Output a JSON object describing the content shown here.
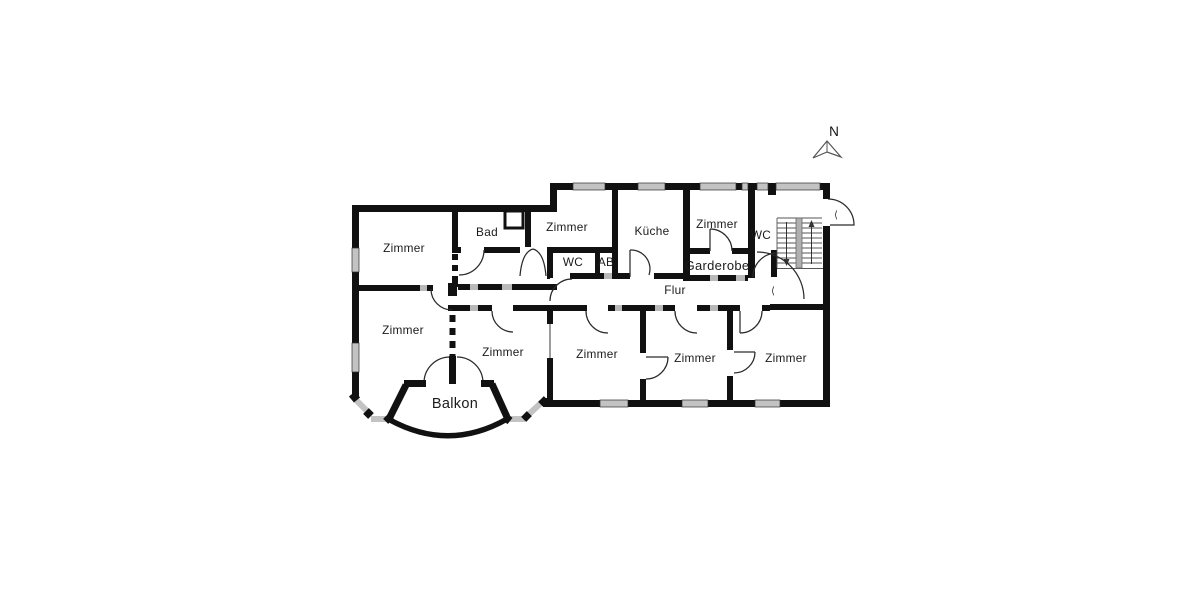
{
  "plan": {
    "compass_label": "N",
    "door_glyph": "⟨",
    "labels": {
      "zimmer_top_left": "Zimmer",
      "bad": "Bad",
      "zimmer_top_mid": "Zimmer",
      "kueche": "Küche",
      "zimmer_top_right": "Zimmer",
      "wc_top_right": "WC",
      "wc_inner": "WC",
      "ab": "AB",
      "garderobe": "Garderobe",
      "flur": "Flur",
      "zimmer_mid_left": "Zimmer",
      "zimmer_bottom_left": "Zimmer",
      "zimmer_bottom_mid": "Zimmer",
      "zimmer_bottom_inner": "Zimmer",
      "zimmer_bottom_right": "Zimmer",
      "balkon": "Balkon"
    },
    "colors": {
      "wall": "#111111",
      "window": "#c3c3c3",
      "background": "#ffffff"
    }
  }
}
